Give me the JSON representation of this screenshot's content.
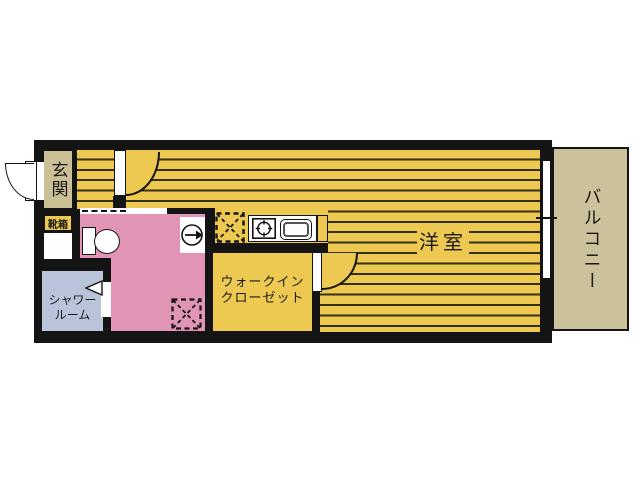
{
  "floorplan": {
    "rooms": {
      "genkan": {
        "label": "玄関"
      },
      "shoebox": {
        "label": "靴箱"
      },
      "shower": {
        "line1": "シャワー",
        "line2": "ルーム"
      },
      "closet": {
        "line1": "ウォークイン",
        "line2": "クローゼット"
      },
      "main_room": {
        "label": "洋室"
      },
      "balcony": {
        "label": "バルコニー"
      }
    },
    "colors": {
      "room_yellow": "#edc952",
      "floor_stripe": "#33300f",
      "washroom_pink": "#e294b6",
      "shower_blue": "#b9c4da",
      "genkan_beige": "#cbbf96",
      "balcony_beige": "#cbc29b",
      "wall_black": "#141414",
      "fixture_white": "#ffffff"
    }
  }
}
